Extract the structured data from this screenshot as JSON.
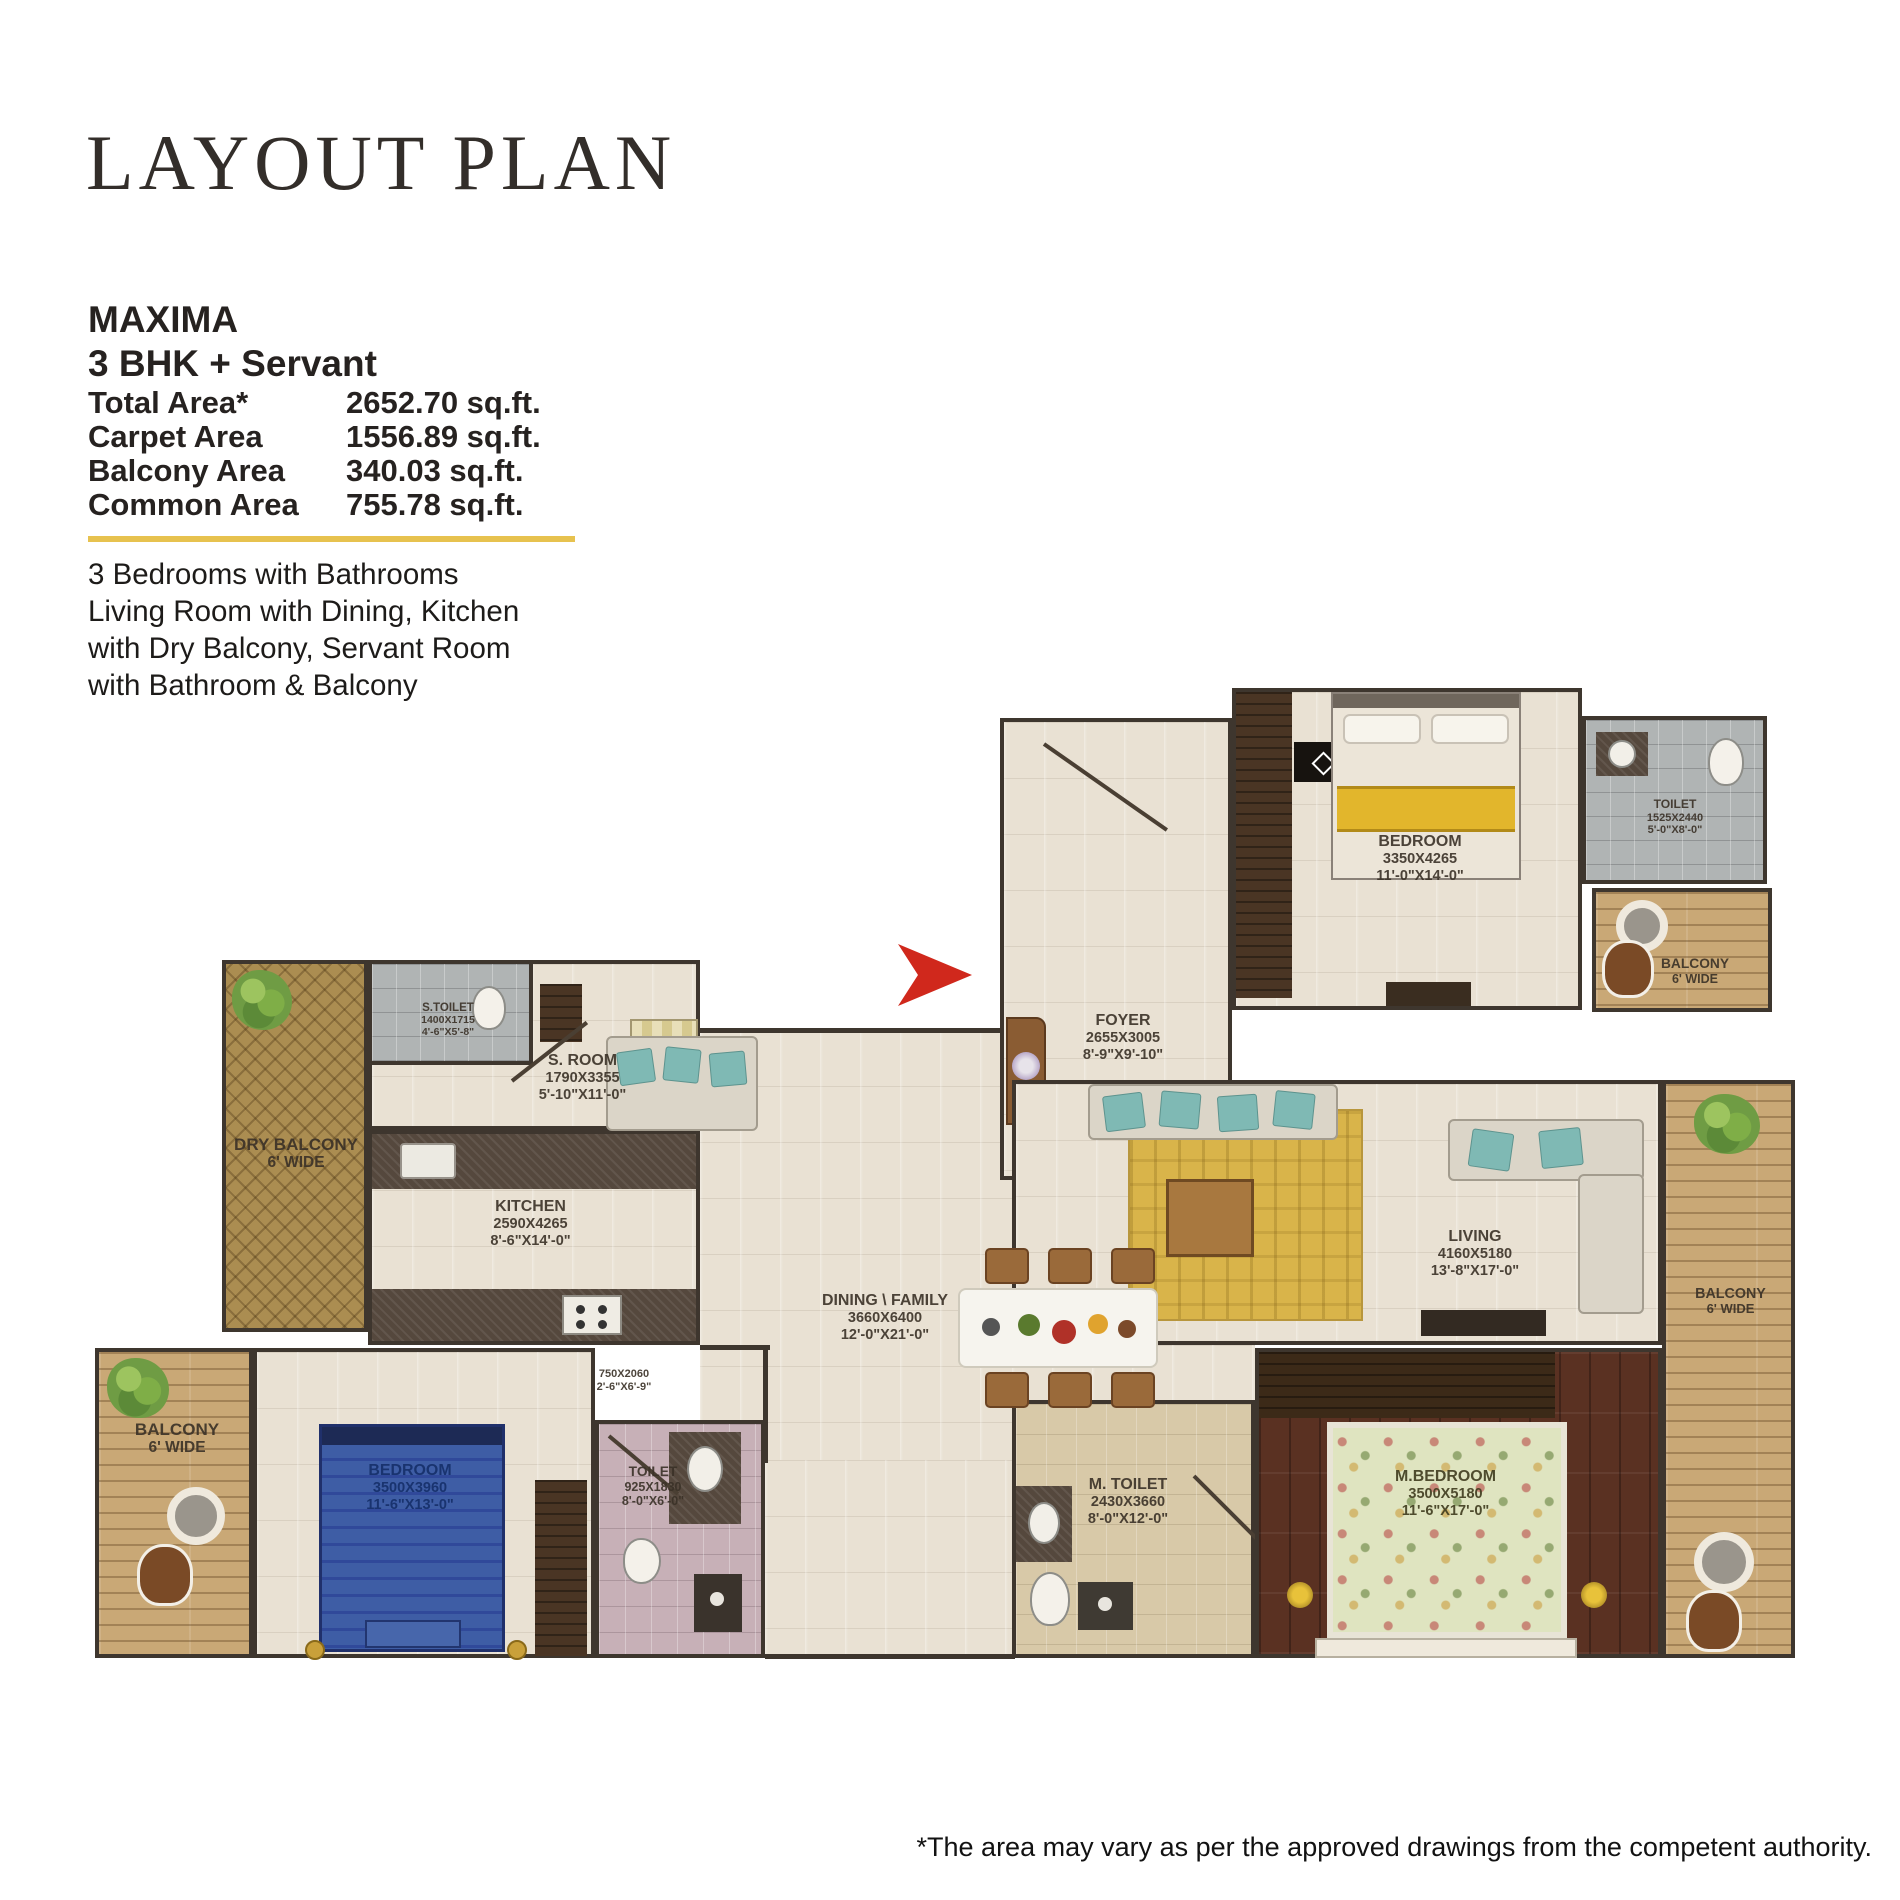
{
  "header": {
    "title": "LAYOUT PLAN"
  },
  "unit": {
    "name": "MAXIMA",
    "config": "3 BHK + Servant",
    "areas": [
      {
        "label": "Total Area*",
        "value": "2652.70 sq.ft."
      },
      {
        "label": "Carpet Area",
        "value": "1556.89 sq.ft."
      },
      {
        "label": "Balcony Area",
        "value": "340.03 sq.ft."
      },
      {
        "label": "Common Area",
        "value": "755.78 sq.ft."
      }
    ],
    "description": [
      "3 Bedrooms with Bathrooms",
      "Living Room with Dining, Kitchen",
      "with Dry Balcony, Servant Room",
      "with Bathroom & Balcony"
    ],
    "accent_color": "#E7C24F"
  },
  "plan": {
    "entry_arrow_color": "#D0281C",
    "bedroom_top": {
      "name": "BEDROOM",
      "mm": "3350X4265",
      "ft": "11'-0\"X14'-0\""
    },
    "toilet_top": {
      "name": "TOILET",
      "mm": "1525X2440",
      "ft": "5'-0\"X8'-0\""
    },
    "balcony_top_right": {
      "name": "BALCONY",
      "size": "6' WIDE"
    },
    "foyer": {
      "name": "FOYER",
      "mm": "2655X3005",
      "ft": "8'-9\"X9'-10\""
    },
    "s_toilet": {
      "name": "S.TOILET",
      "mm": "1400X1715",
      "ft": "4'-6\"X5'-8\""
    },
    "s_room": {
      "name": "S. ROOM",
      "mm": "1790X3355",
      "ft": "5'-10\"X11'-0\""
    },
    "dry_balcony": {
      "name": "DRY BALCONY",
      "size": "6' WIDE"
    },
    "kitchen": {
      "name": "KITCHEN",
      "mm": "2590X4265",
      "ft": "8'-6\"X14'-0\""
    },
    "passage": {
      "mm": "750X2060",
      "ft": "2'-6\"X6'-9\""
    },
    "dining": {
      "name": "DINING \\ FAMILY",
      "mm": "3660X6400",
      "ft": "12'-0\"X21'-0\""
    },
    "living": {
      "name": "LIVING",
      "mm": "4160X5180",
      "ft": "13'-8\"X17'-0\""
    },
    "balcony_left": {
      "name": "BALCONY",
      "size": "6' WIDE"
    },
    "bedroom_bottom": {
      "name": "BEDROOM",
      "mm": "3500X3960",
      "ft": "11'-6\"X13'-0\""
    },
    "toilet_bottom": {
      "name": "TOILET",
      "mm": "925X1830",
      "ft": "8'-0\"X6'-0\""
    },
    "m_toilet": {
      "name": "M. TOILET",
      "mm": "2430X3660",
      "ft": "8'-0\"X12'-0\""
    },
    "m_bedroom": {
      "name": "M.BEDROOM",
      "mm": "3500X5180",
      "ft": "11'-6\"X17'-0\""
    },
    "balcony_right": {
      "name": "BALCONY",
      "size": "6' WIDE"
    }
  },
  "footer": {
    "disclaimer": "*The area may vary as per the approved drawings from the competent authority."
  }
}
